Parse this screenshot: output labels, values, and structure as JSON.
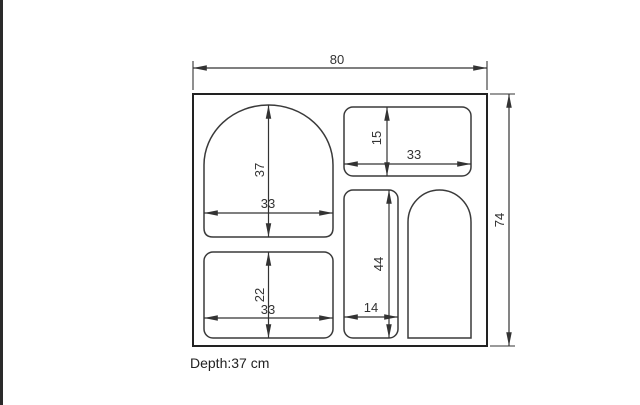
{
  "drawing": {
    "type": "technical-dimension-drawing",
    "unit": "cm",
    "depth_note": "Depth:37 cm",
    "overall": {
      "width": "80",
      "height": "74"
    },
    "compartments": [
      {
        "name": "arch-top-left-niche",
        "shape": "arch-top",
        "width": "33",
        "height": "37"
      },
      {
        "name": "top-right-shelf",
        "shape": "rounded-rect",
        "width": "33",
        "height": "15"
      },
      {
        "name": "bottom-left-shelf",
        "shape": "rounded-rect",
        "width": "33",
        "height": "22"
      },
      {
        "name": "middle-tall-shelf",
        "shape": "rounded-rect",
        "width": "14",
        "height": "44"
      },
      {
        "name": "right-arch-niche",
        "shape": "arch-top",
        "width": "",
        "height": ""
      }
    ],
    "colors": {
      "line": "#333333",
      "outline": "#222222",
      "text": "#333333",
      "edge_bar": "#2a2a2a",
      "background": "#ffffff"
    }
  }
}
